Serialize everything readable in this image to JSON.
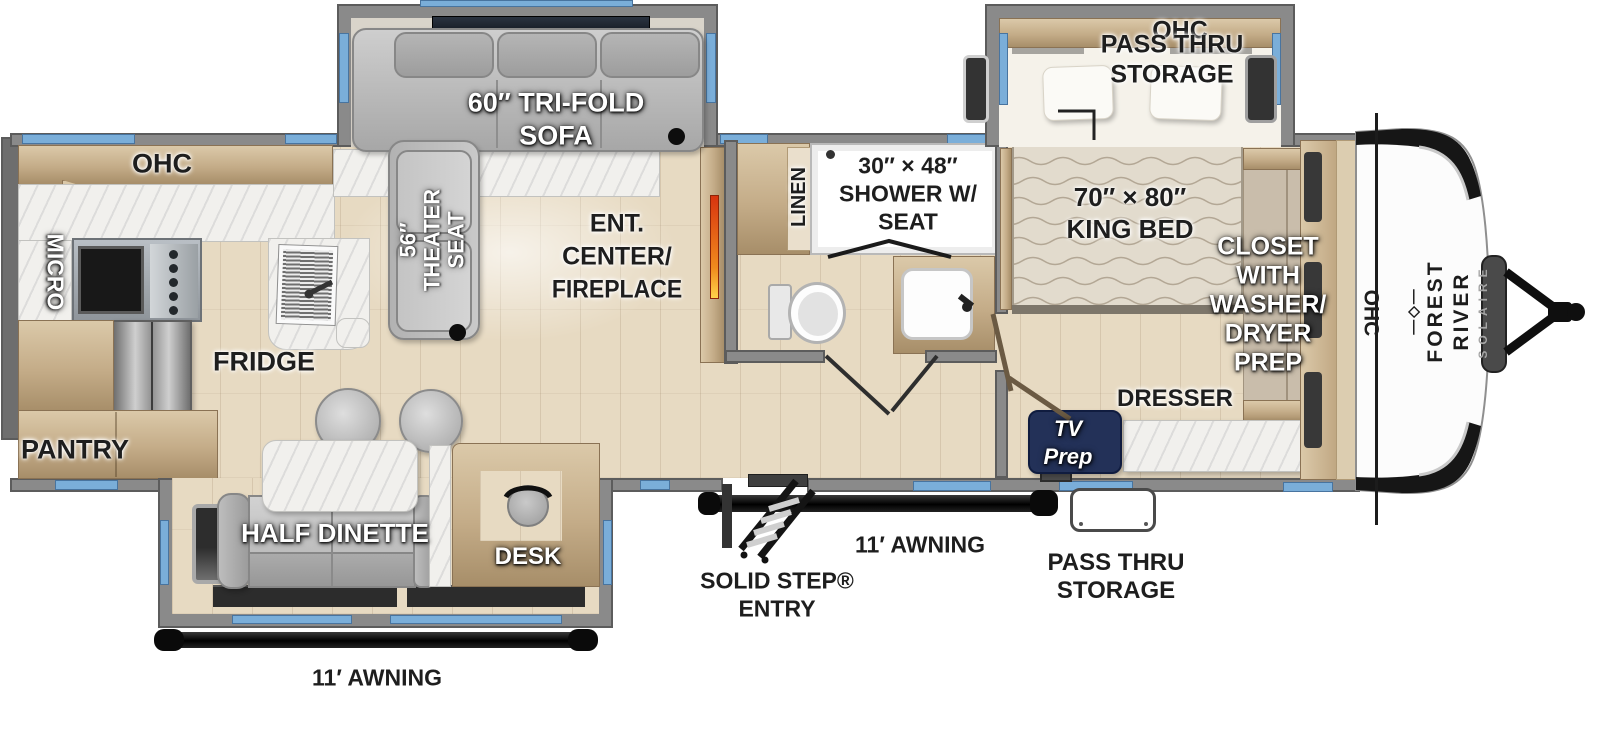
{
  "meta": {
    "title": "Solaire travel trailer floor plan"
  },
  "colors": {
    "window_blue": "#7aaed9",
    "wall_gray": "#8a8a8a",
    "floor_wood": "#e7dac2",
    "cabinet_wood": "#c4ac88",
    "counter_marble": "#f1f0ed",
    "badge_navy": "#233158",
    "fireplace_orange": "#e04a12",
    "awning_black": "#151515"
  },
  "labels": {
    "kitchen_ohc": "OHC",
    "micro": "MICRO",
    "fridge": "FRIDGE",
    "pantry": "PANTRY",
    "sofa_1": "60″ TRI-FOLD",
    "sofa_2": "SOFA",
    "theater_1": "56″",
    "theater_2": "THEATER",
    "theater_3": "SEAT",
    "ent_1": "ENT.",
    "ent_2": "CENTER/",
    "ent_3": "FIREPLACE",
    "linen": "LINEN",
    "shower_1": "30″ × 48″",
    "shower_2": "SHOWER W/",
    "shower_3": "SEAT",
    "bed_1": "70″ × 80″",
    "bed_2": "KING BED",
    "bedroom_ohc": "OHC",
    "closet_1": "CLOSET",
    "closet_2": "WITH",
    "closet_3": "WASHER/",
    "closet_4": "DRYER",
    "closet_5": "PREP",
    "dresser": "DRESSER",
    "tv_prep_1": "TV",
    "tv_prep_2": "Prep",
    "pass_thru_top_1": "PASS THRU",
    "pass_thru_top_2": "STORAGE",
    "pass_thru_bottom_1": "PASS THRU",
    "pass_thru_bottom_2": "STORAGE",
    "awning_left": "11′ AWNING",
    "awning_right": "11′ AWNING",
    "entry_1": "SOLID STEP®",
    "entry_2": "ENTRY",
    "half_dinette": "HALF DINETTE",
    "desk": "DESK",
    "front_ohc": "OHC",
    "brand_logo": "―◇―",
    "brand_name": "FOREST RIVER",
    "brand_model": "SOLAIRE"
  }
}
